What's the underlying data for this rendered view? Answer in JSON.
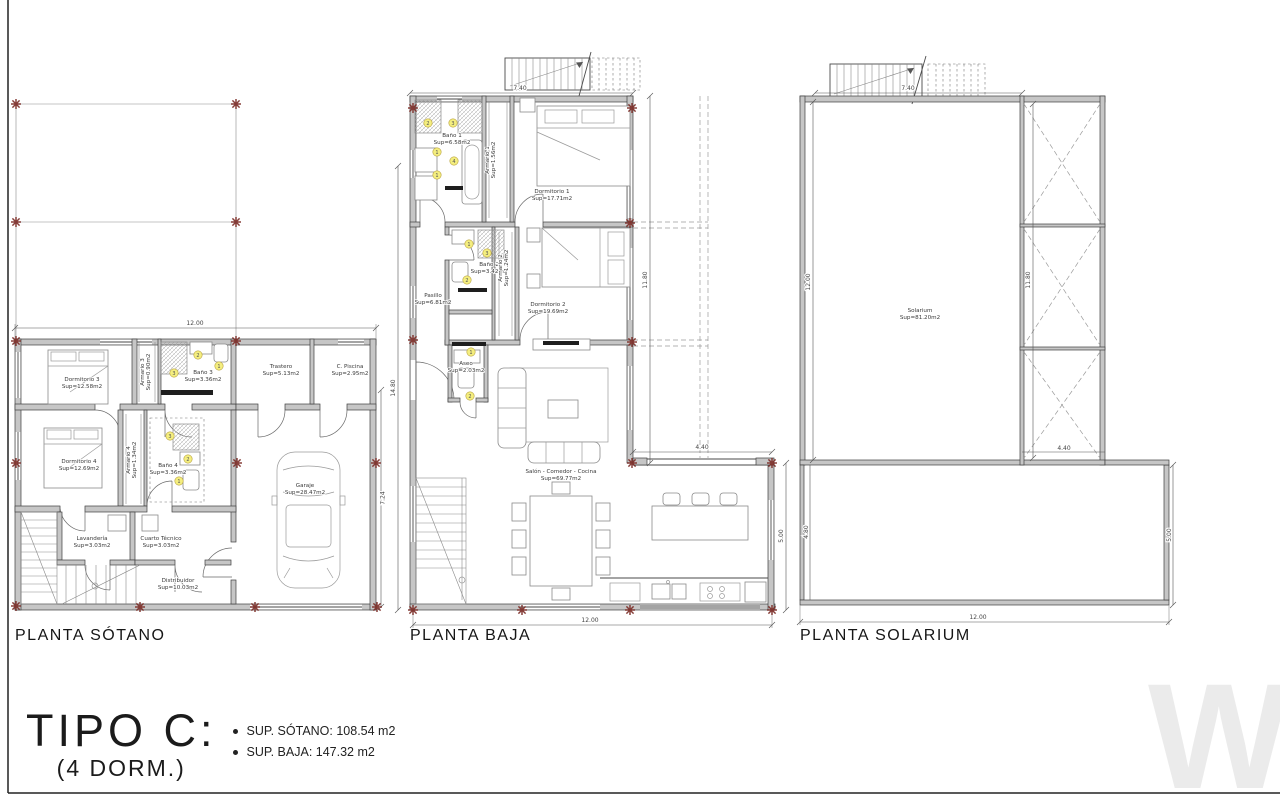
{
  "title_block": {
    "type_label": "TIPO C:",
    "dorm_label": "(4 DORM.)",
    "area_sotano": "SUP. SÓTANO: 108.54 m2",
    "area_baja": "SUP. BAJA: 147.32 m2"
  },
  "watermark": {
    "text": "W"
  },
  "plans": {
    "sotano": {
      "title": "PLANTA SÓTANO",
      "rooms": {
        "dormitorio3": {
          "name": "Dormitorio 3",
          "area": "Sup=12.58m2"
        },
        "armario3": {
          "name": "Armario 3",
          "area": "Sup=0.90m2"
        },
        "bano3": {
          "name": "Baño 3",
          "area": "Sup=3.36m2"
        },
        "trastero": {
          "name": "Trastero",
          "area": "Sup=5.13m2"
        },
        "cpiscina": {
          "name": "C. Piscina",
          "area": "Sup=2.95m2"
        },
        "dormitorio4": {
          "name": "Dormitorio 4",
          "area": "Sup=12.69m2"
        },
        "armario4": {
          "name": "Armario 4",
          "area": "Sup=1.34m2"
        },
        "bano4": {
          "name": "Baño 4",
          "area": "Sup=3.36m2"
        },
        "lavanderia": {
          "name": "Lavandería",
          "area": "Sup=3.03m2"
        },
        "cuartotecnico": {
          "name": "Cuarto Técnico",
          "area": "Sup=3.03m2"
        },
        "distribuidor": {
          "name": "Distribuidor",
          "area": "Sup=10.03m2"
        },
        "garaje": {
          "name": "Garaje",
          "area": "Sup=28.47m2"
        }
      },
      "dims": {
        "width": "12.00",
        "right": "7.24"
      }
    },
    "baja": {
      "title": "PLANTA BAJA",
      "rooms": {
        "bano1": {
          "name": "Baño 1",
          "area": "Sup=6.58m2"
        },
        "armario1": {
          "name": "Armario 1",
          "area": "Sup=1.56m2"
        },
        "dormitorio1": {
          "name": "Dormitorio 1",
          "area": "Sup=17.71m2"
        },
        "bano2": {
          "name": "Baño 2",
          "area": "Sup=3.42m2"
        },
        "armario2": {
          "name": "Armario 2",
          "area": "Sup=1.24m2"
        },
        "dormitorio2": {
          "name": "Dormitorio 2",
          "area": "Sup=19.69m2"
        },
        "pasillo": {
          "name": "Pasillo",
          "area": "Sup=6.81m2"
        },
        "aseo": {
          "name": "Aseo",
          "area": "Sup=2.03m2"
        },
        "salon": {
          "name": "Salón - Comedor - Cocina",
          "area": "Sup=69.77m2"
        }
      },
      "dims": {
        "top": "7.40",
        "left": "14.80",
        "right": "11.80",
        "wing_width": "4.40",
        "wing_height": "5.00",
        "bottom": "12.00"
      }
    },
    "solarium": {
      "title": "PLANTA SOLARIUM",
      "rooms": {
        "solarium": {
          "name": "Solarium",
          "area": "Sup=81.20m2"
        }
      },
      "dims": {
        "top": "7.40",
        "left": "12.00",
        "inner_right": "11.80",
        "strip_width": "4.40",
        "terrace_left": "4.80",
        "terrace_right": "5.00",
        "bottom": "12.00"
      }
    }
  },
  "fixture_badges": [
    {
      "n": "2",
      "x": 198,
      "y": 355
    },
    {
      "n": "1",
      "x": 219,
      "y": 366
    },
    {
      "n": "3",
      "x": 174,
      "y": 373
    },
    {
      "n": "3",
      "x": 170,
      "y": 436
    },
    {
      "n": "2",
      "x": 188,
      "y": 459
    },
    {
      "n": "1",
      "x": 179,
      "y": 481
    },
    {
      "n": "2",
      "x": 428,
      "y": 123
    },
    {
      "n": "3",
      "x": 453,
      "y": 123
    },
    {
      "n": "1",
      "x": 437,
      "y": 152
    },
    {
      "n": "4",
      "x": 454,
      "y": 161
    },
    {
      "n": "1",
      "x": 437,
      "y": 175
    },
    {
      "n": "1",
      "x": 469,
      "y": 244
    },
    {
      "n": "3",
      "x": 487,
      "y": 253
    },
    {
      "n": "2",
      "x": 467,
      "y": 280
    },
    {
      "n": "1",
      "x": 471,
      "y": 352
    },
    {
      "n": "2",
      "x": 470,
      "y": 396
    }
  ],
  "grid_markers": [
    [
      16,
      104
    ],
    [
      236,
      104
    ],
    [
      16,
      222
    ],
    [
      236,
      222
    ],
    [
      16,
      341
    ],
    [
      236,
      341
    ],
    [
      16,
      463
    ],
    [
      237,
      463
    ],
    [
      376,
      463
    ],
    [
      16,
      606
    ],
    [
      140,
      607
    ],
    [
      255,
      607
    ],
    [
      377,
      607
    ],
    [
      413,
      108
    ],
    [
      632,
      108
    ],
    [
      630,
      223
    ],
    [
      413,
      340
    ],
    [
      632,
      342
    ],
    [
      632,
      463
    ],
    [
      772,
      463
    ],
    [
      413,
      610
    ],
    [
      522,
      610
    ],
    [
      630,
      610
    ],
    [
      772,
      610
    ]
  ],
  "colors": {
    "wall_fill": "#c6c6c6",
    "line": "#3f3f3f",
    "marker_red": "#7b2b26",
    "badge_yellow": "#f4ee7f",
    "background": "#ffffff"
  }
}
